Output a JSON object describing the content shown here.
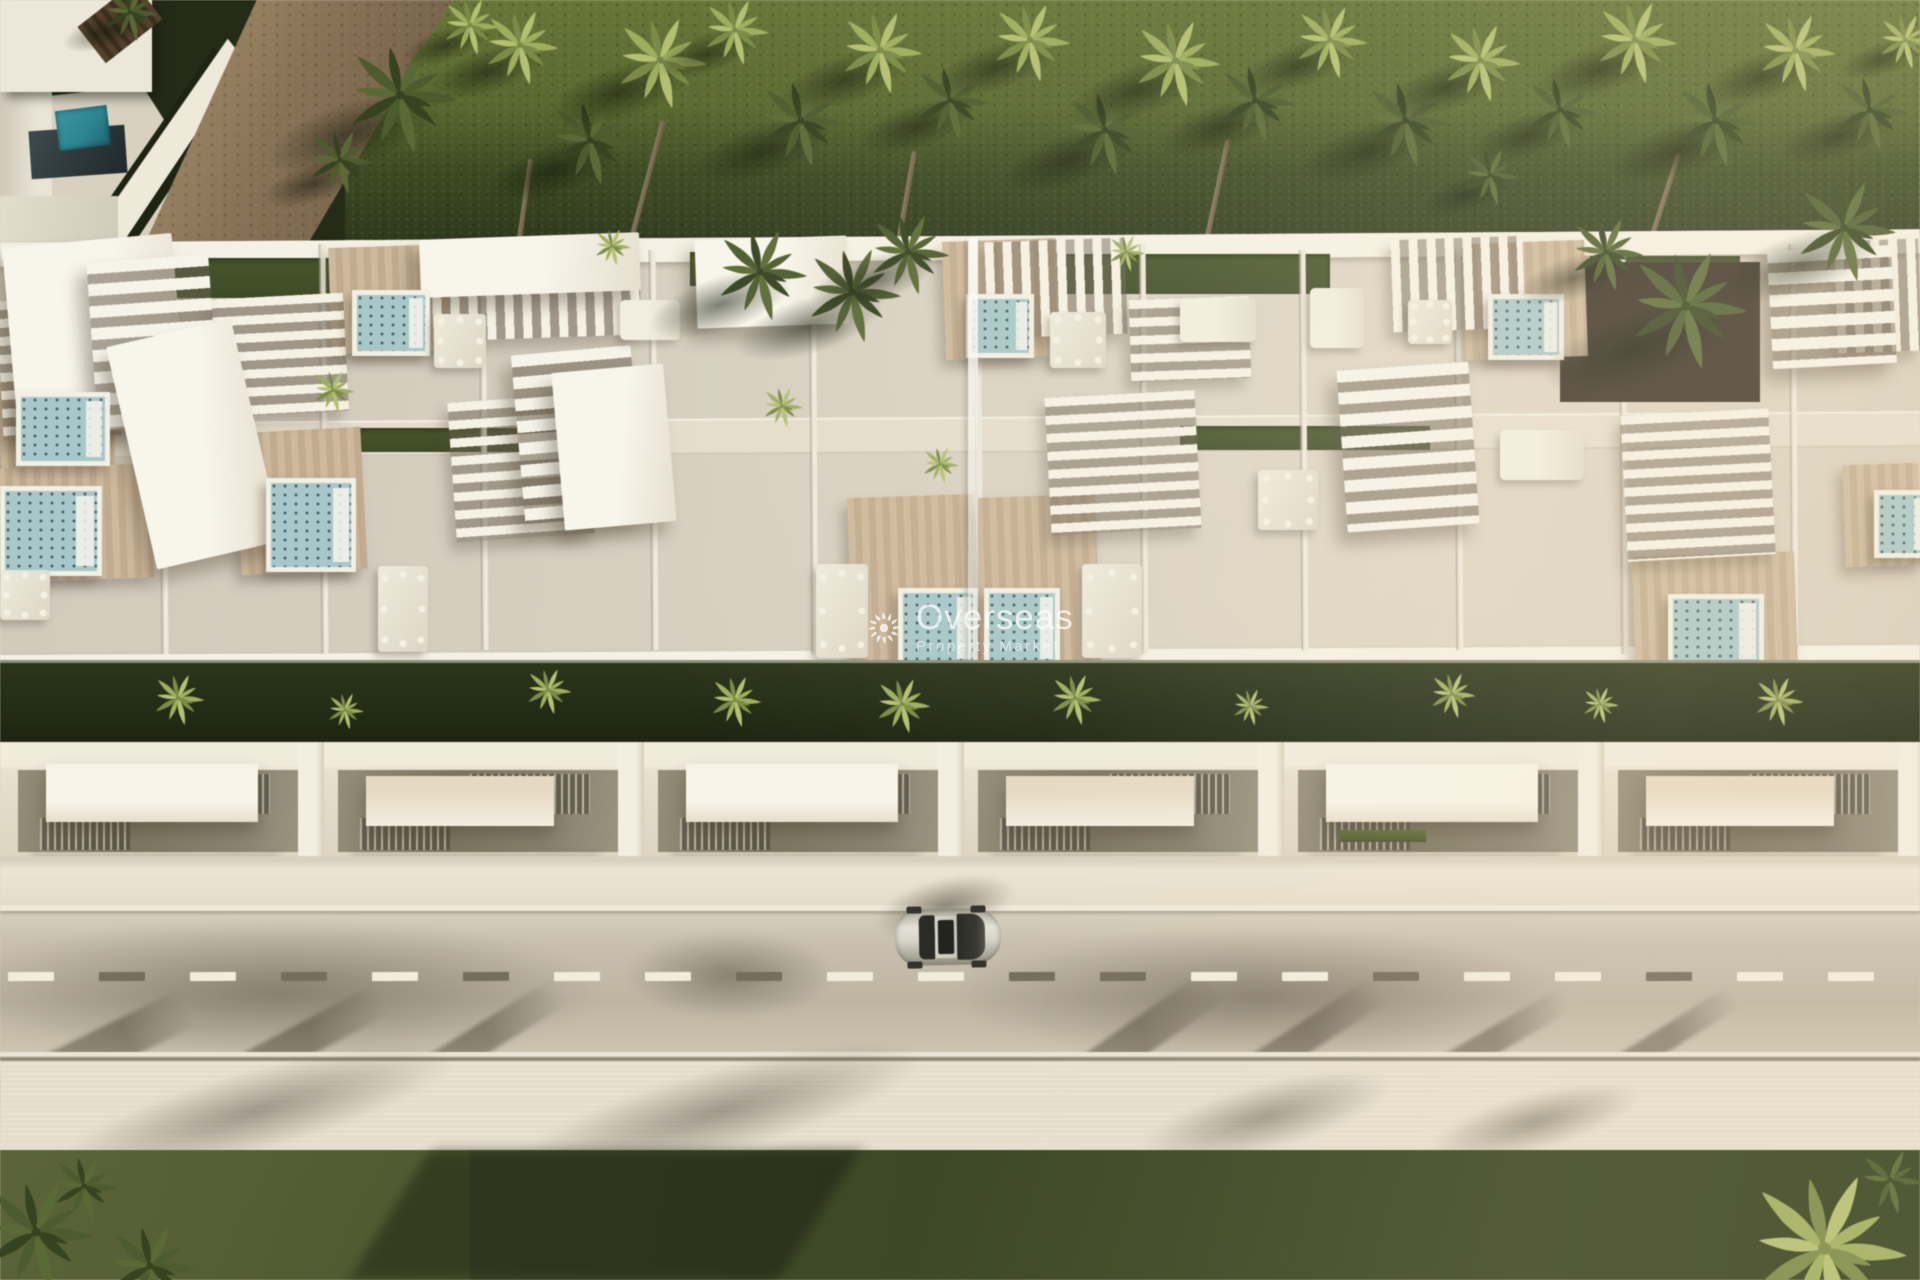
{
  "watermark": {
    "icon": "sun-icon",
    "title": "Overseas",
    "subtitle": "Property Market"
  },
  "palette": {
    "grass_top": "#687638",
    "grass_top_dark": "#2f3a1d",
    "hedge": "#252e16",
    "turf": "#3f4d26",
    "roof_base": "#d7d0c1",
    "roof_white": "#f5f1e4",
    "wood": "#cbb496",
    "jacuzzi_water": "#a7c7c8",
    "facade": "#e7e0cd",
    "glass": "#7d765f",
    "walkway": "#ece5d3",
    "road": "#c9c0ae",
    "dash_bright": "#f2ecdd",
    "dash_dark": "#756d5c",
    "sidewalk": "#e8e1d0",
    "grass_bottom": "#3e4926",
    "grass_bottom_light": "#6e743f",
    "pool": "#2a8492",
    "gravel": "#8a7357",
    "car_body": "#d9d6cb",
    "car_glass": "#2b2b26",
    "watermark": "#ffffff"
  },
  "scene": {
    "palms_top": [
      [
        400,
        95,
        120,
        "d"
      ],
      [
        470,
        25,
        62,
        "l"
      ],
      [
        520,
        45,
        82,
        "l"
      ],
      [
        590,
        140,
        92,
        "d"
      ],
      [
        660,
        60,
        100,
        "l"
      ],
      [
        735,
        30,
        72,
        "l"
      ],
      [
        800,
        120,
        95,
        "d"
      ],
      [
        880,
        50,
        90,
        "l"
      ],
      [
        950,
        100,
        82,
        "d"
      ],
      [
        1030,
        40,
        86,
        "l"
      ],
      [
        1105,
        130,
        92,
        "d"
      ],
      [
        1175,
        60,
        95,
        "l"
      ],
      [
        1255,
        100,
        85,
        "d"
      ],
      [
        1330,
        40,
        80,
        "l"
      ],
      [
        1405,
        120,
        95,
        "d"
      ],
      [
        1480,
        60,
        85,
        "l"
      ],
      [
        1560,
        110,
        80,
        "d"
      ],
      [
        1635,
        40,
        90,
        "l"
      ],
      [
        1715,
        120,
        95,
        "d"
      ],
      [
        1795,
        50,
        85,
        "l"
      ],
      [
        1870,
        110,
        82,
        "d"
      ],
      [
        1905,
        40,
        60,
        "l"
      ],
      [
        340,
        160,
        70,
        "d"
      ],
      [
        1490,
        175,
        62,
        "d"
      ],
      [
        130,
        12,
        60,
        "d"
      ]
    ],
    "trunks_top": [
      [
        640,
        118,
        160,
        15
      ],
      [
        900,
        150,
        140,
        10
      ],
      [
        1210,
        138,
        150,
        12
      ],
      [
        1650,
        150,
        170,
        18
      ],
      [
        520,
        158,
        120,
        8
      ]
    ],
    "turf": [
      [
        60,
        258,
        280,
        40
      ],
      [
        690,
        252,
        150,
        34
      ],
      [
        1010,
        254,
        320,
        40
      ],
      [
        1590,
        256,
        150,
        36
      ],
      [
        345,
        428,
        250,
        24
      ],
      [
        1180,
        426,
        250,
        24
      ]
    ],
    "divider_walls": [
      [
        160,
        244,
        410
      ],
      [
        320,
        244,
        410
      ],
      [
        480,
        250,
        400
      ],
      [
        650,
        250,
        400
      ],
      [
        810,
        244,
        410
      ],
      [
        975,
        238,
        424
      ],
      [
        1140,
        244,
        410
      ],
      [
        1300,
        250,
        400
      ],
      [
        1455,
        250,
        400
      ],
      [
        1620,
        244,
        410
      ],
      [
        1790,
        244,
        410
      ]
    ],
    "white_boxes": [
      [
        10,
        240,
        170,
        190,
        -5,
        0
      ],
      [
        92,
        258,
        122,
        166,
        -4,
        1
      ],
      [
        130,
        330,
        128,
        228,
        -13,
        0
      ],
      [
        518,
        350,
        120,
        170,
        -5,
        1
      ],
      [
        558,
        368,
        112,
        158,
        -5,
        0
      ],
      [
        696,
        238,
        152,
        88,
        -2,
        0
      ],
      [
        1342,
        366,
        132,
        162,
        -4,
        1
      ],
      [
        1770,
        248,
        124,
        118,
        -3,
        1
      ],
      [
        420,
        236,
        220,
        58,
        -2,
        0
      ]
    ],
    "pergolas": [
      [
        214,
        296,
        132,
        118,
        -3,
        "h"
      ],
      [
        432,
        242,
        208,
        96,
        -2,
        "v"
      ],
      [
        986,
        240,
        140,
        96,
        -2,
        "v"
      ],
      [
        1130,
        298,
        120,
        82,
        -2,
        "h"
      ],
      [
        1392,
        238,
        132,
        92,
        -2,
        "v"
      ],
      [
        1624,
        412,
        148,
        146,
        -3,
        "h"
      ],
      [
        452,
        398,
        138,
        140,
        -4,
        "h"
      ],
      [
        1048,
        394,
        150,
        138,
        -3,
        "h"
      ],
      [
        0,
        298,
        118,
        140,
        -3,
        "h"
      ],
      [
        1836,
        240,
        84,
        112,
        -2,
        "v"
      ]
    ],
    "decks": [
      [
        330,
        246,
        120,
        106,
        -2
      ],
      [
        944,
        240,
        114,
        118,
        -2
      ],
      [
        1464,
        242,
        122,
        116,
        -2
      ],
      [
        238,
        430,
        126,
        142,
        -3
      ],
      [
        850,
        496,
        128,
        176,
        -2
      ],
      [
        978,
        496,
        120,
        176,
        -2
      ],
      [
        1634,
        554,
        162,
        126,
        -2
      ],
      [
        0,
        378,
        114,
        98,
        -2
      ],
      [
        0,
        466,
        152,
        114,
        -2
      ],
      [
        1844,
        464,
        76,
        102,
        -2
      ]
    ],
    "jacuzzis": [
      [
        352,
        290,
        68,
        56
      ],
      [
        966,
        294,
        58,
        54
      ],
      [
        1488,
        294,
        66,
        56
      ],
      [
        266,
        478,
        80,
        84
      ],
      [
        898,
        588,
        70,
        70
      ],
      [
        984,
        588,
        66,
        70
      ],
      [
        1668,
        594,
        86,
        64
      ],
      [
        16,
        392,
        84,
        64
      ],
      [
        0,
        486,
        92,
        80
      ],
      [
        1874,
        490,
        46,
        58
      ]
    ],
    "tables": [
      [
        434,
        314,
        52,
        54
      ],
      [
        1050,
        312,
        56,
        56
      ],
      [
        378,
        566,
        50,
        86
      ],
      [
        816,
        564,
        52,
        94
      ],
      [
        1082,
        564,
        60,
        94
      ],
      [
        0,
        570,
        50,
        50
      ],
      [
        1408,
        300,
        44,
        44
      ],
      [
        1258,
        470,
        60,
        60
      ]
    ],
    "loungers": [
      [
        1180,
        298,
        76,
        44
      ],
      [
        1500,
        430,
        84,
        50
      ],
      [
        620,
        300,
        60,
        40
      ],
      [
        1310,
        288,
        54,
        60
      ]
    ],
    "gravel_beds": [
      [
        1560,
        262,
        200,
        140
      ]
    ],
    "roof_palms": [
      [
        333,
        390,
        46
      ],
      [
        782,
        406,
        44
      ],
      [
        940,
        464,
        40
      ],
      [
        612,
        246,
        40
      ],
      [
        1126,
        252,
        40
      ],
      [
        1686,
        306,
        130
      ],
      [
        1606,
        252,
        80
      ],
      [
        760,
        272,
        100
      ],
      [
        852,
        292,
        104
      ],
      [
        908,
        252,
        88
      ],
      [
        1844,
        228,
        110
      ]
    ],
    "hedge_palms": [
      [
        178,
        698,
        56
      ],
      [
        548,
        690,
        50
      ],
      [
        735,
        700,
        56
      ],
      [
        902,
        704,
        60
      ],
      [
        1075,
        698,
        56
      ],
      [
        1452,
        694,
        50
      ],
      [
        1778,
        700,
        54
      ],
      [
        345,
        710,
        40
      ],
      [
        1250,
        706,
        40
      ],
      [
        1600,
        704,
        40
      ]
    ],
    "facade_modules": [
      0,
      320,
      640,
      960,
      1280,
      1600
    ],
    "road_dashes": {
      "y": 972,
      "len": 46,
      "gap": 45,
      "colors": [
        "b",
        "d",
        "b",
        "d",
        "b",
        "d",
        "b",
        "b",
        "d",
        "b",
        "b",
        "d",
        "d",
        "b",
        "b",
        "d",
        "b",
        "b",
        "d",
        "b",
        "b"
      ]
    },
    "trunk_shadows": [
      [
        60,
        940,
        40,
        240,
        64
      ],
      [
        240,
        925,
        34,
        280,
        62
      ],
      [
        418,
        920,
        30,
        300,
        58
      ],
      [
        1068,
        915,
        36,
        320,
        55
      ],
      [
        1240,
        920,
        30,
        300,
        57
      ],
      [
        1430,
        930,
        26,
        280,
        60
      ],
      [
        1612,
        935,
        24,
        260,
        58
      ]
    ],
    "soft_shadows": [
      [
        -60,
        916,
        680,
        150
      ],
      [
        940,
        926,
        640,
        140
      ],
      [
        620,
        930,
        220,
        90
      ]
    ],
    "frond_shadows": [
      [
        40,
        1068,
        430,
        86
      ],
      [
        500,
        1066,
        440,
        90
      ],
      [
        1130,
        1082,
        270,
        70
      ],
      [
        1420,
        1092,
        230,
        60
      ],
      [
        560,
        1150,
        360,
        120
      ]
    ],
    "grass_palms": [
      [
        36,
        1232,
        120,
        "d"
      ],
      [
        150,
        1266,
        96,
        "d"
      ],
      [
        84,
        1186,
        70,
        "d"
      ],
      [
        1824,
        1248,
        175,
        "l"
      ],
      [
        1890,
        1180,
        70,
        "d"
      ]
    ],
    "car": {
      "x": 895,
      "y": 907
    }
  }
}
